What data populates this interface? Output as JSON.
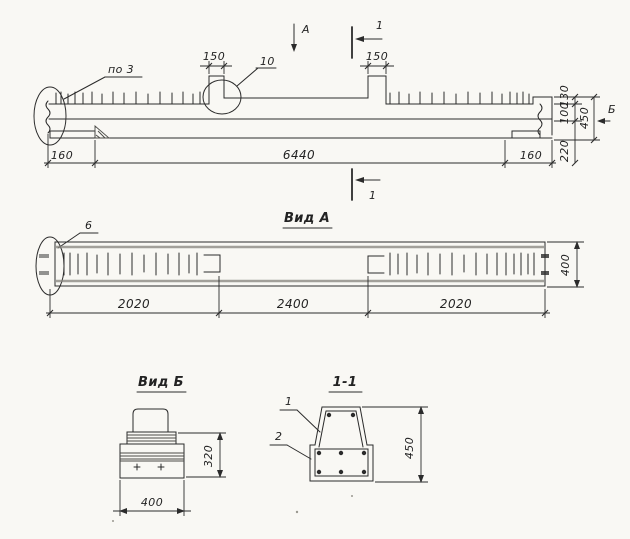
{
  "colors": {
    "paper": "#f9f8f4",
    "ink": "#2b2b2b",
    "shading_band": "#84837c"
  },
  "elevation": {
    "view_arrow_label": "А",
    "section_mark_top": "1",
    "section_mark_bottom": "1",
    "detail_callout_left": "по 3",
    "detail_callout_mid": "10",
    "stub_width_dim_left": "150",
    "stub_width_dim_right": "150",
    "overall_length_dim": "6440",
    "end_bearing_dim_left": "160",
    "end_bearing_dim_right": "160",
    "height_dim_top": "130",
    "height_dim_mid": "100",
    "height_dim_overall": "450",
    "height_dim_bottom": "220",
    "side_view_label": "Б"
  },
  "view_a": {
    "title": "Вид А",
    "detail_callout": "6",
    "span_dim_left": "2020",
    "span_dim_mid": "2400",
    "span_dim_right": "2020",
    "width_dim": "400"
  },
  "view_b": {
    "title": "Вид Б",
    "height_dim": "320",
    "width_dim": "400"
  },
  "section_1_1": {
    "title": "1-1",
    "rebar_callout_top": "1",
    "rebar_callout_bottom": "2",
    "height_dim": "450"
  }
}
